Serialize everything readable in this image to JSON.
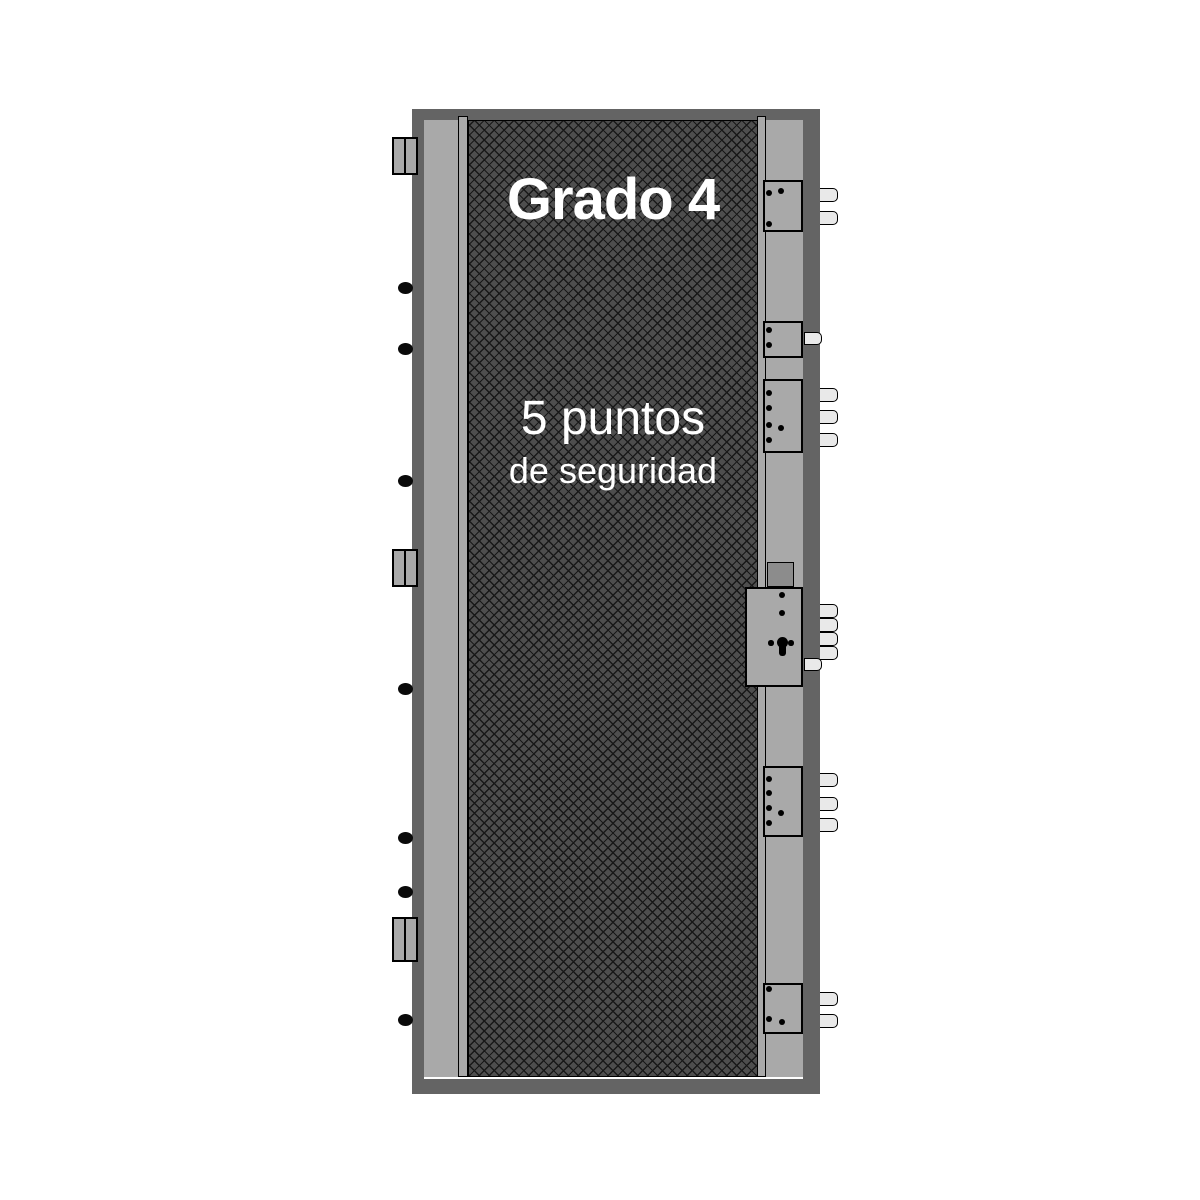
{
  "door": {
    "grade_label": "Grado 4",
    "points_label": "5 puntos",
    "points_sub_label": "de seguridad",
    "hinges": [
      {
        "y": 137,
        "h": 38
      },
      {
        "y": 549,
        "h": 38
      },
      {
        "y": 917,
        "h": 45
      }
    ],
    "hinge_pins": [
      {
        "y": 282
      },
      {
        "y": 343
      },
      {
        "y": 475
      },
      {
        "y": 683
      },
      {
        "y": 832
      },
      {
        "y": 886
      },
      {
        "y": 1014
      }
    ],
    "lock_boxes": [
      {
        "name": "strike-box-1",
        "x": 763,
        "y": 180,
        "w": 40,
        "h": 52,
        "dots": [
          [
            769,
            193
          ],
          [
            781,
            191
          ],
          [
            769,
            224
          ]
        ]
      },
      {
        "name": "strike-box-2",
        "x": 763,
        "y": 321,
        "w": 40,
        "h": 37,
        "dots": [
          [
            769,
            330
          ],
          [
            769,
            345
          ]
        ]
      },
      {
        "name": "strike-box-3",
        "x": 763,
        "y": 379,
        "w": 40,
        "h": 74,
        "dots": [
          [
            769,
            393
          ],
          [
            769,
            408
          ],
          [
            769,
            425
          ],
          [
            781,
            428
          ],
          [
            769,
            440
          ]
        ]
      },
      {
        "name": "main-lock-case",
        "x": 745,
        "y": 587,
        "w": 58,
        "h": 100,
        "dots": [
          [
            782,
            595
          ],
          [
            782,
            613
          ]
        ],
        "keyhole": true
      },
      {
        "name": "strike-box-4",
        "x": 763,
        "y": 766,
        "w": 40,
        "h": 71,
        "dots": [
          [
            769,
            779
          ],
          [
            769,
            793
          ],
          [
            769,
            808
          ],
          [
            781,
            813
          ],
          [
            769,
            823
          ]
        ]
      },
      {
        "name": "strike-box-5",
        "x": 763,
        "y": 983,
        "w": 40,
        "h": 51,
        "dots": [
          [
            769,
            989
          ],
          [
            769,
            1019
          ],
          [
            782,
            1022
          ]
        ]
      }
    ],
    "dark_block": {
      "x": 767,
      "y": 562,
      "w": 27,
      "h": 25
    },
    "keyhole": {
      "cx": 782,
      "cy": 642,
      "r": 5.5,
      "stem_h": 13,
      "side_dots": [
        [
          771,
          643
        ],
        [
          791,
          643
        ]
      ]
    },
    "bolts": [
      {
        "y": 188
      },
      {
        "y": 211
      },
      {
        "y": 332,
        "small": true
      },
      {
        "y": 388
      },
      {
        "y": 410
      },
      {
        "y": 433
      },
      {
        "y": 604
      },
      {
        "y": 618
      },
      {
        "y": 632
      },
      {
        "y": 646
      },
      {
        "y": 658,
        "small": true
      },
      {
        "y": 773
      },
      {
        "y": 797
      },
      {
        "y": 818
      },
      {
        "y": 992
      },
      {
        "y": 1014
      }
    ]
  },
  "colors": {
    "background": "#ffffff",
    "frame": "#646464",
    "leaf": "#a9a9a9",
    "panel": "#4e4e4e",
    "hatch": "#181818",
    "box": "#a9a9a9",
    "dark_block": "#8c8c8c",
    "bolt": "#e9e9e9",
    "pin": "#0a0a0a",
    "outline": "#000000",
    "text": "#ffffff"
  }
}
